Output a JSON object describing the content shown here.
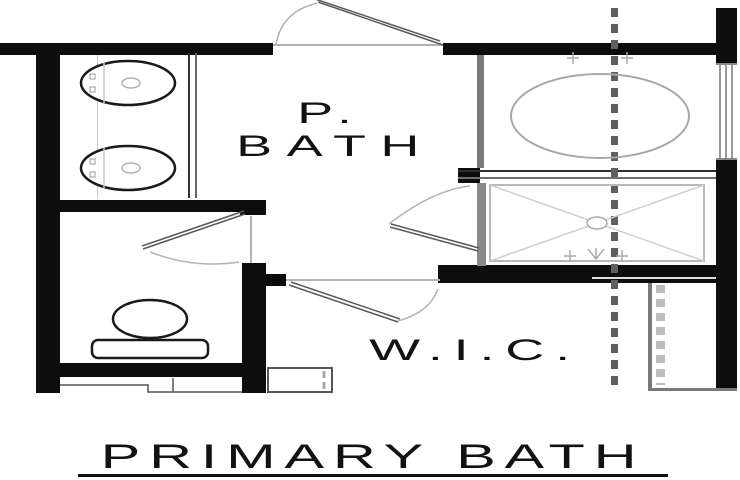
{
  "plan": {
    "title": "PRIMARY BATH",
    "rooms": [
      {
        "id": "primary-bath",
        "label_line1": "P.",
        "label_line2": "BATH"
      },
      {
        "id": "walk-in-closet",
        "label": "W.I.C."
      }
    ],
    "fixtures": [
      "double-vanity-sink-left",
      "double-vanity-sink-right",
      "toilet",
      "bathtub",
      "shower-pan",
      "window",
      "closet-rod",
      "centerline"
    ],
    "colors": {
      "bg": "#ffffff",
      "wall": "#0d0d0d",
      "fixture": "#1a1a1a",
      "detail": "#a9a9a9",
      "door": "#5a5a5a",
      "arc": "#b3b3b3",
      "centerline": "#5f5f5f",
      "closetdash": "#bdbdbd",
      "gray": "#7a7a7a",
      "text": "#121212"
    }
  }
}
